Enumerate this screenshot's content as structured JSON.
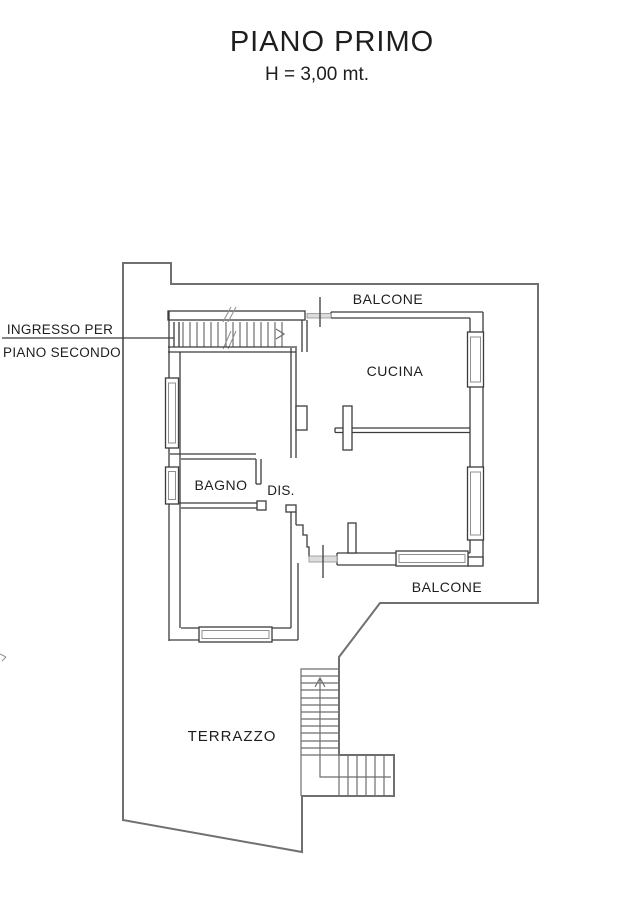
{
  "header": {
    "title": "PIANO PRIMO",
    "subtitle": "H = 3,00 mt."
  },
  "annotations": {
    "entrance_label_line1": "INGRESSO PER",
    "entrance_label_line2": "PIANO SECONDO"
  },
  "rooms": {
    "balcone_top": "BALCONE",
    "cucina": "CUCINA",
    "bagno": "BAGNO",
    "dis": "DIS.",
    "balcone_bottom": "BALCONE",
    "terrazzo": "TERRAZZO"
  },
  "colors": {
    "wall_line": "#3c3c3c",
    "boundary_line": "#707070",
    "stair_line": "#6e6e6e",
    "threshold_fill": "#dcdcdc",
    "text": "#1e1e1e",
    "background": "#ffffff"
  }
}
